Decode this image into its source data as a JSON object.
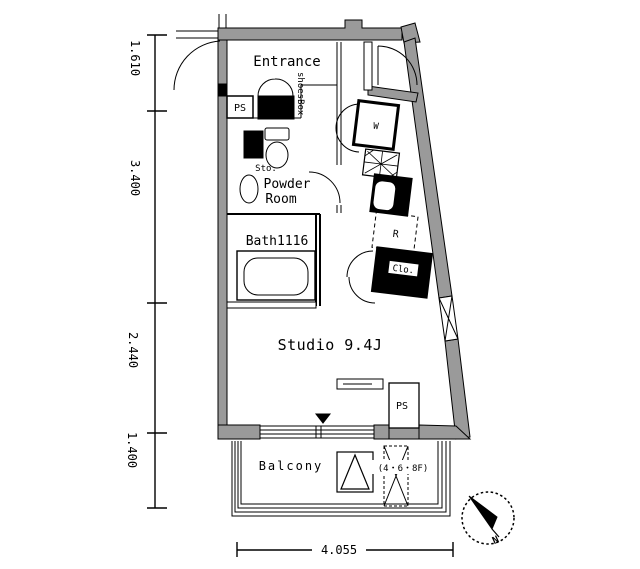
{
  "plan": {
    "rooms": {
      "entrance": "Entrance",
      "powder_room_line1": "Powder",
      "powder_room_line2": "Room",
      "bath": "Bath1116",
      "studio": "Studio 9.4J",
      "balcony": "Balcony"
    },
    "fixtures": {
      "shoes_box": "shoesBox",
      "storage": "Sto.",
      "washer": "W",
      "fridge": "R",
      "closet": "Clo.",
      "ps_upper": "PS",
      "ps_lower": "PS",
      "hatch_floors": "(4・6・8F)"
    },
    "compass": {
      "north": "N"
    },
    "dimensions": {
      "left": [
        "1.610",
        "3.400",
        "2.440",
        "1.400"
      ],
      "bottom": "4.055"
    },
    "colors": {
      "wall_gray": "#9a9a9a",
      "line_black": "#000000",
      "background": "#ffffff"
    }
  }
}
